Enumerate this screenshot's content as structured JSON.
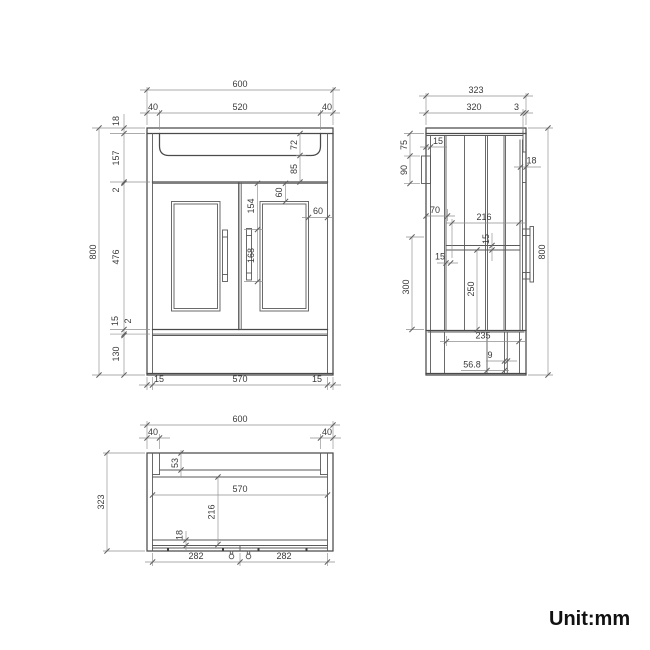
{
  "meta": {
    "unit_label": "Unit:mm",
    "drawing_type": "bathroom vanity unit orthographic views",
    "colors": {
      "line_main": "#4a4a4a",
      "line_dim": "#8f8f8f",
      "text": "#3a3a3a",
      "background": "#ffffff"
    }
  },
  "front": {
    "overall_width": "600",
    "basin_inset_left": "40",
    "basin_width": "520",
    "basin_inset_right": "40",
    "counter_thickness": "18",
    "apron_height": "157",
    "top_gap": "2",
    "bowl_depth": "72",
    "bowl_clearance": "85",
    "door_height": "476",
    "bottom_rail": "15",
    "bottom_gap": "2",
    "plinth_height": "130",
    "overall_height": "800",
    "panel_top_inset": "60",
    "handle_top_offset": "154",
    "handle_length": "168",
    "panel_side_inset": "60",
    "base_margin_left": "15",
    "base_width": "570",
    "base_margin_right": "15"
  },
  "side": {
    "overall_depth": "323",
    "body_depth": "320",
    "back_panel": "3",
    "bracket_top_offset": "75",
    "bracket_height": "90",
    "bracket_width": "15",
    "door_thickness": "18",
    "back_gap": "70",
    "interior_depth": "216",
    "shelf_thickness": "15",
    "panel_gap": "15",
    "shelf_height": "250",
    "opening_height": "300",
    "overall_height": "800",
    "base_depth": "235",
    "foot_offset": "9",
    "foot_depth": "56.8"
  },
  "plan": {
    "overall_width": "600",
    "corner_left": "40",
    "corner_right": "40",
    "overall_depth": "323",
    "back_rail": "53",
    "interior_width": "570",
    "interior_depth": "216",
    "front_rail": "18",
    "door_left": "282",
    "door_right": "282"
  }
}
